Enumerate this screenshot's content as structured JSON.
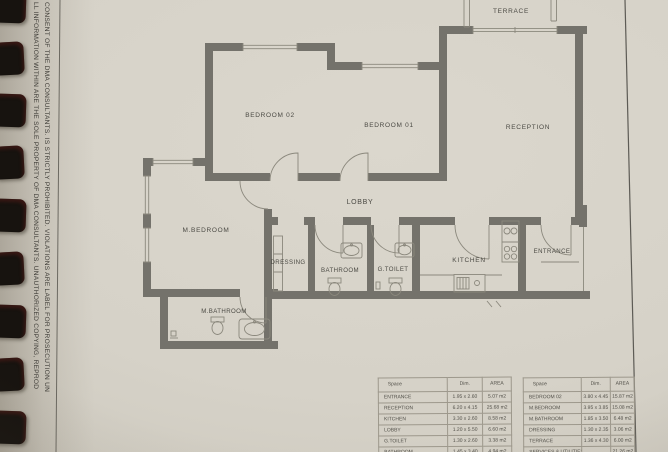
{
  "page": {
    "disclaimer_line_1": "LL INFORMATION WITHIN ARE THE SOLE PROPERTY OF DMA CONSULTANTS. UNAUTHORIZED COPYING, REPROD",
    "disclaimer_line_2": "CONSENT OF THE DMA CONSULTANTS. IS STRICTLY PROHIBITED. VIOLATIONS ARE LABEL FOR PROSECUTION UN"
  },
  "plan": {
    "rooms": {
      "terrace": "TERRACE",
      "bedroom02": "BEDROOM 02",
      "bedroom01": "BEDROOM 01",
      "reception": "RECEPTION",
      "lobby": "LOBBY",
      "mbedroom": "M.BEDROOM",
      "dressing": "DRESSING",
      "bathroom": "BATHROOM",
      "gtoilet": "G.TOILET",
      "kitchen": "KITCHEN",
      "entrance": "ENTRANCE",
      "mbathroom": "M.BATHROOM"
    },
    "colors": {
      "paper": "#d6d2c8",
      "wall": "#74726b",
      "line": "#8b887d",
      "text": "#4b4a44"
    }
  },
  "tables": [
    {
      "headers": {
        "space": "Space",
        "dim": "Dim.",
        "area": "AREA"
      },
      "rows": [
        {
          "space": "ENTRANCE",
          "dim": "1.95 x 2.60",
          "area": "5.07 m2"
        },
        {
          "space": "RECEPTION",
          "dim": "6.20 x 4.15",
          "area": "25.68 m2"
        },
        {
          "space": "KITCHEN",
          "dim": "3.30 x 2.60",
          "area": "8.58 m2"
        },
        {
          "space": "LOBBY",
          "dim": "1.20 x 5.50",
          "area": "6.60 m2"
        },
        {
          "space": "G.TOILET",
          "dim": "1.30 x 2.60",
          "area": "3.38 m2"
        },
        {
          "space": "BATHROOM",
          "dim": "1.45 x 3.40",
          "area": "4.94 m2"
        }
      ]
    },
    {
      "headers": {
        "space": "Space",
        "dim": "Dim.",
        "area": "AREA"
      },
      "rows": [
        {
          "space": "BEDROOM 02",
          "dim": "3.80 x 4.45",
          "area": "15.87 m2"
        },
        {
          "space": "M.BEDROOM",
          "dim": "3.95 x 3.85",
          "area": "15.08 m2"
        },
        {
          "space": "M.BATHROOM",
          "dim": "1.85 x 3.50",
          "area": "6.48 m2"
        },
        {
          "space": "DRESSING",
          "dim": "1.30 x 2.35",
          "area": "3.06 m2"
        },
        {
          "space": "TERRACE",
          "dim": "1.36 x 4.30",
          "area": "6.00 m2"
        },
        {
          "space": "SERVICES & UTILITIES",
          "dim": "",
          "area": "21.26 m2"
        }
      ]
    }
  ]
}
